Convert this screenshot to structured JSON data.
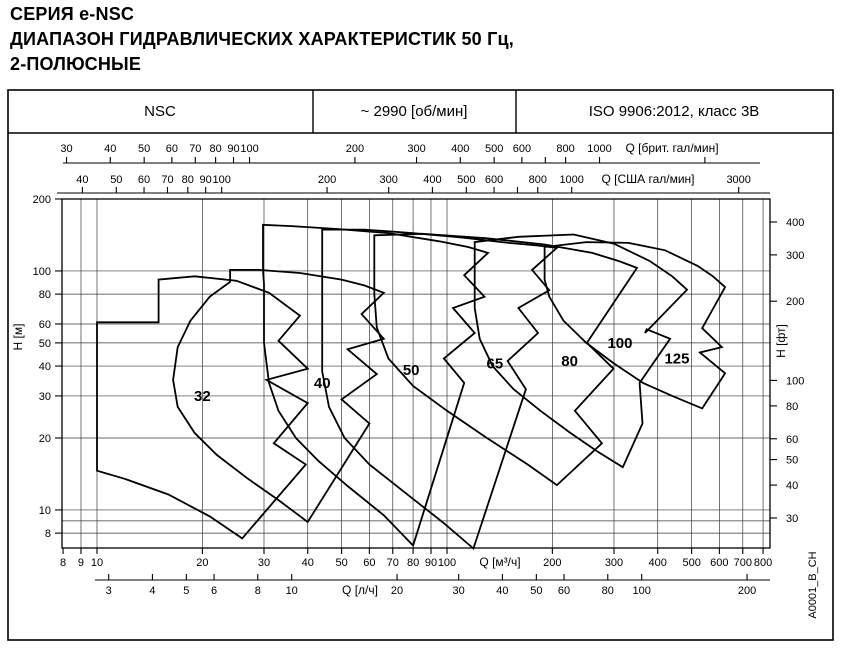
{
  "title_lines": [
    "СЕРИЯ e-NSC",
    "ДИАПАЗОН ГИДРАВЛИЧЕСКИХ ХАРАКТЕРИСТИК 50 Гц,",
    "2-ПОЛЮСНЫЕ"
  ],
  "header": {
    "series": "NSC",
    "speed": "~ 2990 [об/мин]",
    "standard": "ISO 9906:2012, класс 3В"
  },
  "side_note": "A0001_B_CH",
  "chart_data": {
    "type": "area",
    "x_scale": "log",
    "y_scale": "log",
    "x_range_m3h": [
      8,
      837
    ],
    "y_range_m": [
      6.9,
      200
    ],
    "axes": {
      "top_imp": {
        "label": "Q [брит. гал/мин]",
        "unit_per_m3h": 3.666,
        "labeled_ticks": [
          30,
          40,
          50,
          60,
          70,
          80,
          90,
          100,
          200,
          300,
          400,
          500,
          600,
          800,
          1000
        ],
        "unlabeled_ticks": [
          700,
          2000
        ]
      },
      "top_us": {
        "label": "Q [США гал/мин]",
        "unit_per_m3h": 4.403,
        "labeled_ticks": [
          40,
          50,
          60,
          70,
          80,
          90,
          100,
          200,
          300,
          400,
          500,
          600,
          800,
          1000,
          3000
        ],
        "unlabeled_ticks": [
          700
        ]
      },
      "bottom_m3h": {
        "label": "Q [м³/ч]",
        "labeled_ticks": [
          8,
          9,
          10,
          20,
          30,
          40,
          50,
          60,
          70,
          80,
          90,
          100,
          200,
          300,
          400,
          500,
          600,
          700,
          800
        ]
      },
      "bottom_ls": {
        "label": "Q [л/ч]",
        "unit_per_m3h": 0.2778,
        "labeled_ticks": [
          3,
          4,
          5,
          6,
          8,
          10,
          20,
          30,
          40,
          50,
          60,
          80,
          100,
          200
        ]
      },
      "left": {
        "label": "H [м]",
        "labeled_ticks": [
          200,
          100,
          80,
          60,
          50,
          40,
          30,
          20,
          10,
          8
        ]
      },
      "right": {
        "label": "H [фт]",
        "unit_per_m": 3.2808,
        "labeled_ticks": [
          400,
          300,
          200,
          100,
          80,
          60,
          50,
          40,
          30
        ]
      }
    },
    "grid": {
      "x_lines_m3h": [
        9,
        10,
        20,
        30,
        40,
        50,
        60,
        70,
        80,
        90,
        100,
        200,
        300,
        400,
        500,
        600,
        700,
        800
      ],
      "y_lines_m": [
        8,
        9,
        10,
        20,
        30,
        40,
        50,
        60,
        80,
        100
      ]
    },
    "series": [
      {
        "name": "32",
        "label_at": [
          20,
          30
        ],
        "points": [
          [
            10,
            61
          ],
          [
            15,
            61
          ],
          [
            15,
            92
          ],
          [
            19,
            95
          ],
          [
            25,
            91
          ],
          [
            31,
            81
          ],
          [
            38,
            65
          ],
          [
            33,
            51
          ],
          [
            40,
            39
          ],
          [
            30.5,
            35
          ],
          [
            40,
            28
          ],
          [
            32,
            19
          ],
          [
            39.5,
            15.5
          ],
          [
            26,
            7.6
          ],
          [
            21,
            9.4
          ],
          [
            16,
            11.6
          ],
          [
            12,
            13.5
          ],
          [
            10,
            14.6
          ]
        ]
      },
      {
        "name": "40",
        "label_at": [
          44,
          34
        ],
        "points": [
          [
            24,
            90
          ],
          [
            24,
            101
          ],
          [
            29,
            101
          ],
          [
            38,
            98
          ],
          [
            50,
            92
          ],
          [
            58,
            87
          ],
          [
            66,
            81
          ],
          [
            57,
            66
          ],
          [
            66,
            52
          ],
          [
            52,
            47
          ],
          [
            63,
            37
          ],
          [
            50,
            29
          ],
          [
            60,
            23
          ],
          [
            40,
            8.9
          ],
          [
            33,
            11
          ],
          [
            27,
            13.5
          ],
          [
            22,
            17
          ],
          [
            19,
            21
          ],
          [
            17,
            27
          ],
          [
            16.5,
            35
          ],
          [
            17,
            48
          ],
          [
            18.5,
            62
          ],
          [
            21,
            78
          ]
        ]
      },
      {
        "name": "50",
        "label_at": [
          79,
          38.5
        ],
        "points": [
          [
            29.8,
            101
          ],
          [
            29.8,
            156
          ],
          [
            36,
            154
          ],
          [
            48,
            150
          ],
          [
            68,
            144
          ],
          [
            95,
            133
          ],
          [
            115,
            126
          ],
          [
            131,
            119
          ],
          [
            112,
            96
          ],
          [
            128,
            78
          ],
          [
            104,
            70
          ],
          [
            120,
            55
          ],
          [
            98,
            43
          ],
          [
            112,
            34
          ],
          [
            80,
            7.1
          ],
          [
            66,
            9.5
          ],
          [
            52,
            12.6
          ],
          [
            43,
            16
          ],
          [
            37,
            20
          ],
          [
            33,
            26
          ],
          [
            31,
            34
          ],
          [
            30,
            50
          ],
          [
            30,
            70
          ],
          [
            30,
            88
          ]
        ]
      },
      {
        "name": "65",
        "label_at": [
          137,
          41
        ],
        "points": [
          [
            44,
            120
          ],
          [
            44,
            149
          ],
          [
            58,
            149
          ],
          [
            80,
            144
          ],
          [
            110,
            138
          ],
          [
            150,
            131
          ],
          [
            180,
            128
          ],
          [
            206,
            125
          ],
          [
            175,
            101
          ],
          [
            196,
            83
          ],
          [
            160,
            70
          ],
          [
            182,
            55
          ],
          [
            149,
            42
          ],
          [
            168,
            32
          ],
          [
            119,
            6.9
          ],
          [
            98,
            8.8
          ],
          [
            76,
            11.8
          ],
          [
            60,
            15.5
          ],
          [
            51,
            20
          ],
          [
            46,
            27
          ],
          [
            44,
            38
          ],
          [
            44,
            60
          ],
          [
            44,
            85
          ],
          [
            44,
            105
          ]
        ]
      },
      {
        "name": "80",
        "label_at": [
          224,
          42
        ],
        "points": [
          [
            62,
            115
          ],
          [
            62,
            141
          ],
          [
            85,
            143
          ],
          [
            130,
            137
          ],
          [
            190,
            129
          ],
          [
            260,
            119
          ],
          [
            310,
            110
          ],
          [
            349,
            103
          ],
          [
            251,
            50
          ],
          [
            299,
            39
          ],
          [
            232,
            26
          ],
          [
            277,
            19
          ],
          [
            206,
            12.7
          ],
          [
            170,
            15.5
          ],
          [
            130,
            20
          ],
          [
            100,
            26
          ],
          [
            80,
            33
          ],
          [
            68,
            43
          ],
          [
            63,
            58
          ],
          [
            62,
            80
          ],
          [
            62,
            100
          ]
        ]
      },
      {
        "name": "100",
        "label_at": [
          312,
          50
        ],
        "points": [
          [
            120,
            108
          ],
          [
            120,
            132
          ],
          [
            160,
            139
          ],
          [
            230,
            142
          ],
          [
            300,
            130
          ],
          [
            380,
            110
          ],
          [
            440,
            95
          ],
          [
            485,
            83.5
          ],
          [
            368,
            55
          ],
          [
            372,
            57
          ],
          [
            434,
            52
          ],
          [
            355,
            34
          ],
          [
            362,
            23
          ],
          [
            318,
            15.1
          ],
          [
            270,
            17.5
          ],
          [
            225,
            21
          ],
          [
            185,
            26
          ],
          [
            155,
            32
          ],
          [
            135,
            40
          ],
          [
            124,
            52
          ],
          [
            120,
            70
          ],
          [
            120,
            90
          ]
        ]
      },
      {
        "name": "125",
        "label_at": [
          454,
          43
        ],
        "points": [
          [
            190,
            100
          ],
          [
            190,
            126
          ],
          [
            250,
            132
          ],
          [
            330,
            131
          ],
          [
            420,
            122
          ],
          [
            520,
            105
          ],
          [
            575,
            95
          ],
          [
            623,
            85.6
          ],
          [
            536,
            57.6
          ],
          [
            610,
            48
          ],
          [
            528,
            45.6
          ],
          [
            623,
            37.3
          ],
          [
            536,
            26.6
          ],
          [
            440,
            30
          ],
          [
            363,
            34
          ],
          [
            300,
            41
          ],
          [
            250,
            50
          ],
          [
            215,
            62
          ],
          [
            196,
            78
          ],
          [
            190,
            92
          ]
        ]
      }
    ]
  }
}
